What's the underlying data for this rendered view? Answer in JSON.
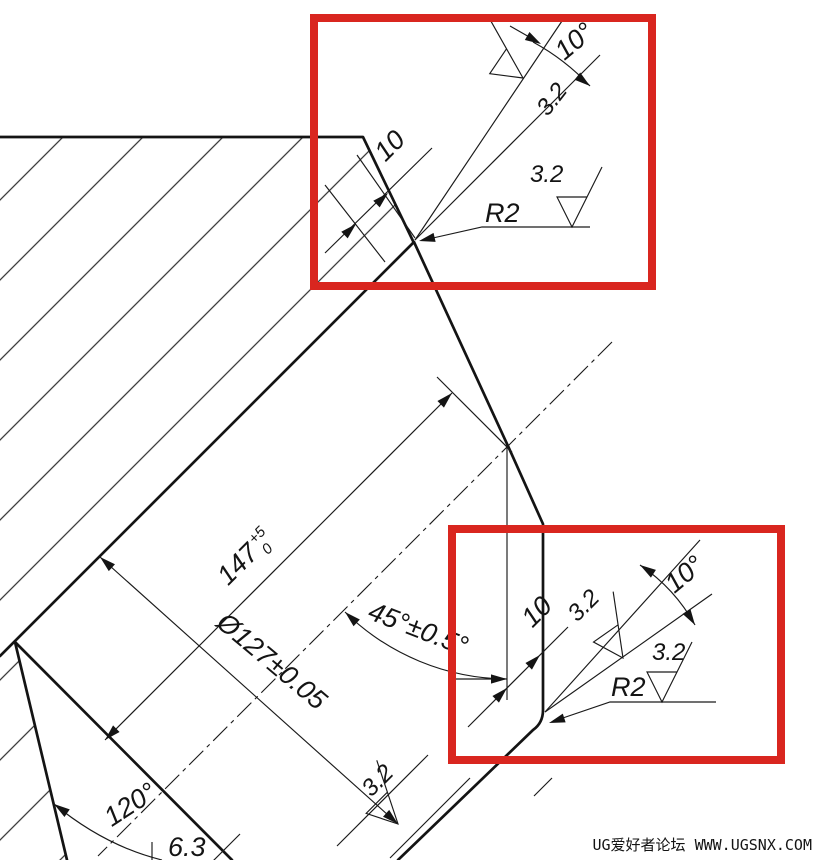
{
  "drawing_title": "V-ring cross-section detail with chamfer and groove callouts",
  "colors": {
    "line": "#141414",
    "highlight_red": "#d9261f",
    "watermark_gray": "#a9a9a9",
    "background": "#ffffff"
  },
  "annotations": {
    "top_detail": {
      "taper_angle": "10°",
      "roughness_taper": "3.2",
      "roughness_face": "3.2",
      "fillet_radius": "R2",
      "chamfer_width": "10"
    },
    "middle": {
      "cone_length": "147",
      "tol_upper": "+5",
      "tol_lower": "0",
      "cone_angle": "45°±0.5°",
      "diameter": "Ø127±0.05"
    },
    "bottom_detail": {
      "land_width": "10",
      "roughness_taper": "3.2",
      "taper_angle": "10°",
      "roughness_face": "3.2",
      "fillet_radius": "R2"
    },
    "groove": {
      "included_angle": "120°",
      "width": "6.3",
      "roughness": "3.2"
    }
  },
  "watermark": "UG爱好者论坛 WWW.UGSNX.COM"
}
